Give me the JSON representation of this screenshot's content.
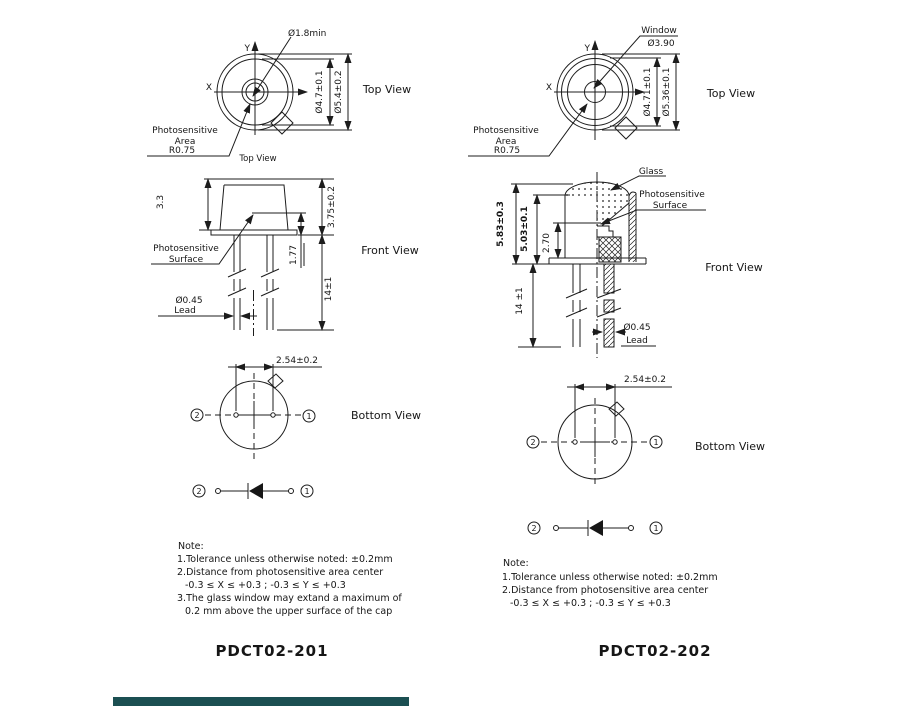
{
  "colors": {
    "line": "#1c1c1c",
    "background": "#ffffff",
    "bottom_bar": "#1b4f52"
  },
  "l": {
    "title": "PDCT02-201",
    "top": {
      "view_label": "Top View",
      "view_label_small": "Top View",
      "window_dia": "Ø1.8min",
      "axis_x": "X",
      "axis_y": "Y",
      "ps1": "Photosensitive",
      "ps2": "Area",
      "radius": "R0.75",
      "dim_inner": "Ø4.7±0.1",
      "dim_outer": "Ø5.4±0.2"
    },
    "front": {
      "view_label": "Front View",
      "dim_cap": "3.3",
      "dim_total": "3.75±0.2",
      "dim_surface": "1.77",
      "dim_lead_len": "14±1",
      "lead_dia": "Ø0.45",
      "lead": "Lead",
      "ps1": "Photosensitive",
      "ps2": "Surface"
    },
    "bottom": {
      "view_label": "Bottom View",
      "pitch": "2.54±0.2",
      "pin1": "1",
      "pin2": "2"
    },
    "schematic": {
      "pin1": "1",
      "pin2": "2"
    },
    "note": {
      "head": "Note:",
      "l1": "1.Tolerance unless otherwise noted: ±0.2mm",
      "l2": "2.Distance from photosensitive area center",
      "l3": "-0.3 ≤ X ≤ +0.3 ; -0.3 ≤ Y ≤ +0.3",
      "l4": "3.The glass window may extand a maximum of",
      "l5": "0.2 mm above the upper surface of the cap"
    }
  },
  "r": {
    "title": "PDCT02-202",
    "top": {
      "view_label": "Top View",
      "window": "Window",
      "window_dia": "Ø3.90",
      "axis_x": "X",
      "axis_y": "Y",
      "ps1": "Photosensitive",
      "ps2": "Area",
      "radius": "R0.75",
      "dim_inner": "Ø4.71±0.1",
      "dim_outer": "Ø5.36±0.1"
    },
    "front": {
      "view_label": "Front View",
      "glass": "Glass",
      "ps1": "Photosensitive",
      "ps2": "Surface",
      "dim_total": "5.83±0.3",
      "dim_cap": "5.03±0.1",
      "dim_surface": "2.70",
      "dim_lead_len": "14 ±1",
      "lead_dia": "Ø0.45",
      "lead": "Lead"
    },
    "bottom": {
      "view_label": "Bottom View",
      "pitch": "2.54±0.2",
      "pin1": "1",
      "pin2": "2"
    },
    "schematic": {
      "pin1": "1",
      "pin2": "2"
    },
    "note": {
      "head": "Note:",
      "l1": "1.Tolerance unless otherwise noted: ±0.2mm",
      "l2": "2.Distance from photosensitive area center",
      "l3": "-0.3 ≤ X ≤ +0.3 ; -0.3 ≤ Y ≤ +0.3"
    }
  }
}
